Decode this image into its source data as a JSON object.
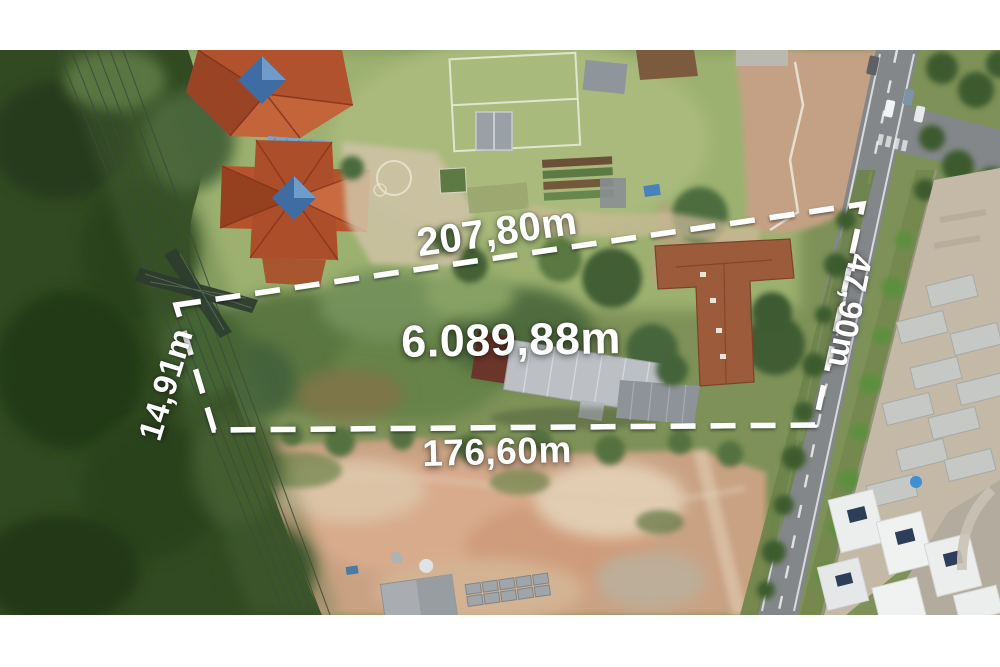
{
  "annotation": {
    "top_edge": "207,80m",
    "right_edge": "47,90m",
    "bottom_edge": "176,60m",
    "left_edge": "14,91m",
    "area": "6.089,88m",
    "line_color": "#ffffff",
    "text_color": "#ffffff"
  }
}
